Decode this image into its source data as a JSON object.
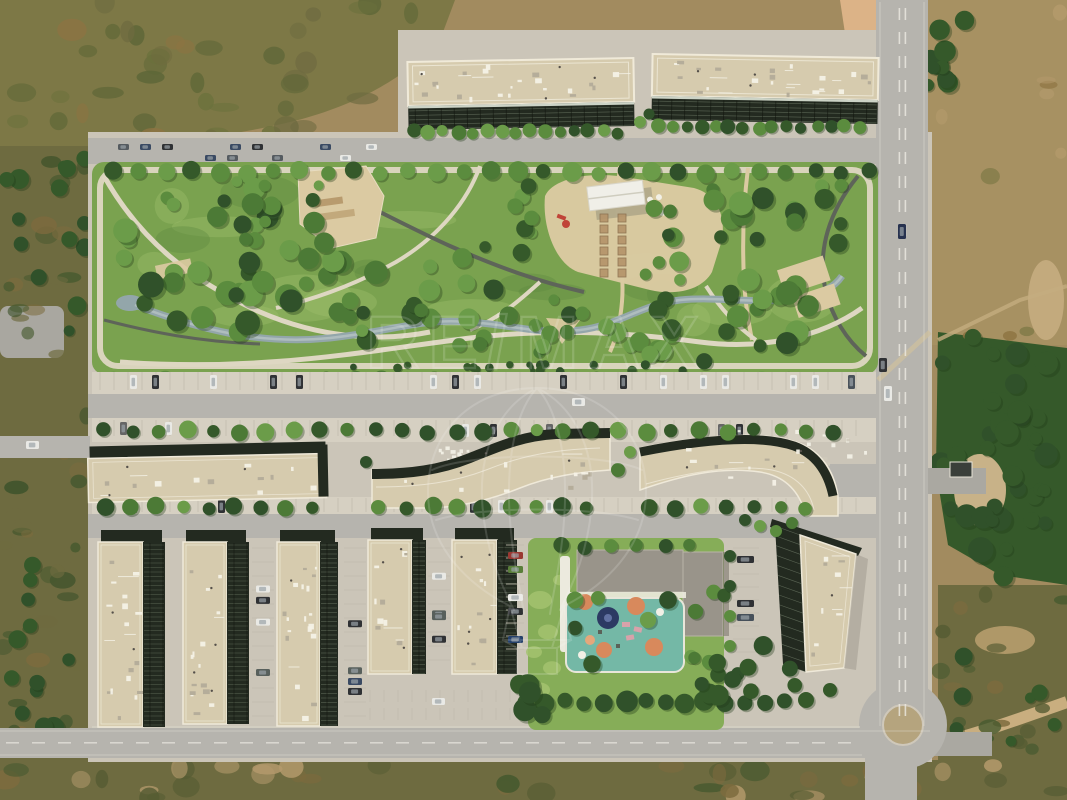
{
  "scene": {
    "type": "aerial-drone-render",
    "description": "Top-down aerial rendering of a new residential development: two long apartment slabs at the top, a large landscaped central park with winding paths, a stream and sandy plazas, a middle band of curved low-rise buildings with tree-lined parking, five vertical apartment blocks at the bottom-left, a school building with a colorful playground, a tilted block by a roundabout at the bottom-right, all surrounded by dry scrubland and a main avenue on the right.",
    "watermark": {
      "text": "RE/MAX",
      "logo": "hot-air-balloon-outline",
      "color": "#ffffff",
      "opacity": 0.15
    }
  },
  "palette": {
    "field": "#a28b5f",
    "field2": "#a79162",
    "scrub": "#7d7846",
    "scrub2": "#6e6b40",
    "treeDark": "#35592a",
    "tree": "#4c7a36",
    "treeLight": "#6b9c49",
    "lawn": "#7aa24f",
    "lawn2": "#86ad58",
    "lawnLight": "#a3c26f",
    "concrete": "#cbc5b8",
    "concreteLight": "#d6d0c2",
    "road": "#b6b4ae",
    "roadDark": "#aaa8a1",
    "gravel": "#ded7c2",
    "sand": "#dbcaa2",
    "asphaltPath": "#5e6459",
    "water": "#93a6aa",
    "waterLight": "#c2cdcc",
    "roofBeige": "#d6cbae",
    "roofLine": "#f2edde",
    "facade": "#232a20",
    "facadeLine": "#9cab92",
    "grayRoof": "#99948a",
    "dirt": "#c9ae7f",
    "rubble": "#a9a7a0",
    "teal": "#74b8a6",
    "orange": "#d8895c",
    "navy": "#2c3a63",
    "pink": "#d8a2aa",
    "white": "#f2f0e6",
    "carDark": "#2f3134",
    "carWhite": "#e9e9e5",
    "shadow": "#8a8578"
  }
}
